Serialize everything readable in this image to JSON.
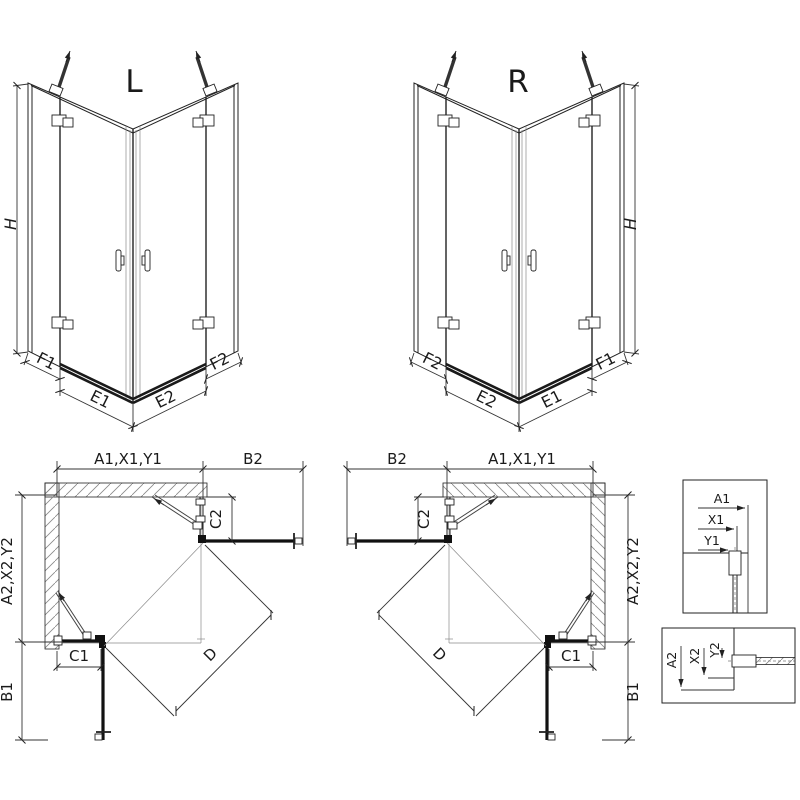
{
  "colors": {
    "line": "#222222",
    "dark": "#111111",
    "hatch": "#888888",
    "background": "#ffffff"
  },
  "iso_views": {
    "left": {
      "label": "L",
      "height_dim": "H",
      "bottom_dims": [
        "F1",
        "E1",
        "E2",
        "F2"
      ]
    },
    "right": {
      "label": "R",
      "height_dim": "H",
      "bottom_dims": [
        "F2",
        "E2",
        "E1",
        "F1"
      ]
    }
  },
  "plan_views": {
    "left": {
      "top_span": "A1,X1,Y1",
      "door_reach_top": "B2",
      "side_panel": "C2",
      "side_span": "A2,X2,Y2",
      "bottom_panel": "C1",
      "door_reach_bottom": "B1",
      "diagonal": "D"
    },
    "right": {
      "top_span": "A1,X1,Y1",
      "door_reach_top": "B2",
      "side_panel": "C2",
      "side_span": "A2,X2,Y2",
      "bottom_panel": "C1",
      "door_reach_bottom": "B1",
      "diagonal": "D"
    }
  },
  "detail_views": {
    "top_profile": {
      "dims": [
        "A1",
        "X1",
        "Y1"
      ]
    },
    "side_profile": {
      "dims": [
        "A2",
        "X2",
        "Y2"
      ]
    }
  }
}
